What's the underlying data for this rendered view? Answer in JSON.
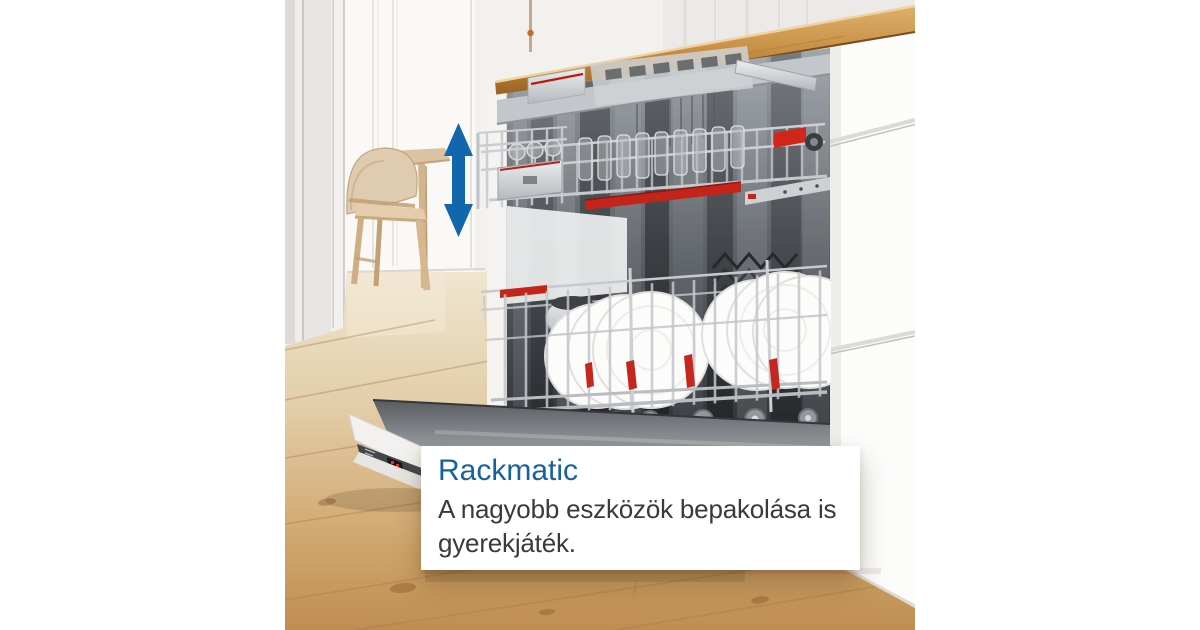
{
  "caption": {
    "title": "Rackmatic",
    "body_lines": [
      "A nagyobb eszközök bepakolása is",
      "gyerekjáték."
    ]
  },
  "colors": {
    "title_blue": "#16629f",
    "arrow_blue": "#1166ae",
    "accent_red": "#c4251b",
    "counter_wood": "#c89045",
    "floor_wood": "#cb9b63",
    "card_background": "#ffffff"
  },
  "icons": {
    "height_arrow": "double-headed-vertical-arrow"
  }
}
